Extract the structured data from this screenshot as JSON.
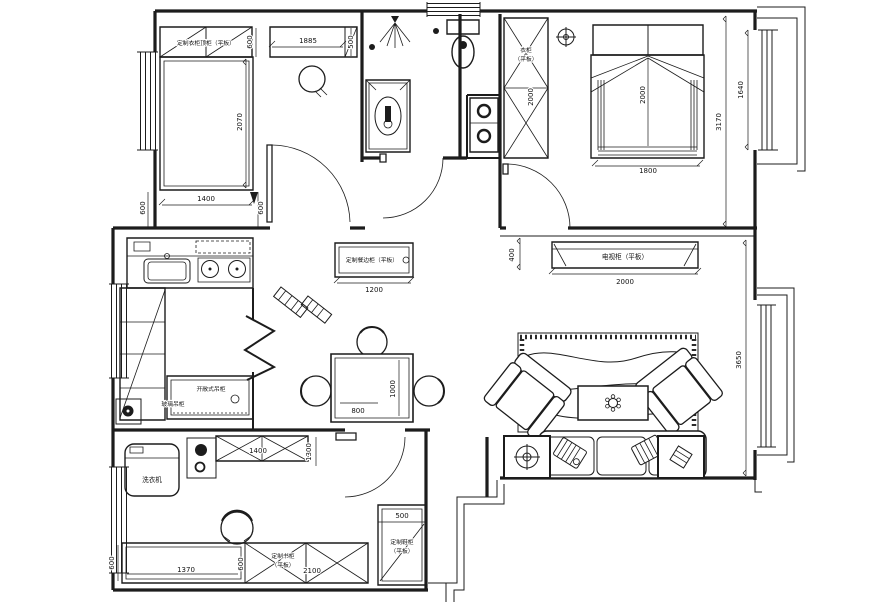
{
  "drawing": {
    "type": "apartment-floor-plan",
    "labels": {
      "wardrobe_top": "定制衣柜顶柜（平板）",
      "master_wardrobe_line1": "衣柜",
      "master_wardrobe_line2": "（平板）",
      "tv_cabinet": "电视柜（平板）",
      "sideboard": "定制餐边柜（平板）",
      "open_shelf": "开敞式吊柜",
      "glass_cabinet": "玻璃吊柜",
      "washing_machine": "洗衣机",
      "bookcase_line1": "定制书柜",
      "bookcase_line2": "（平板）",
      "shoe_cabinet_line1": "定制鞋柜",
      "shoe_cabinet_line2": "（平板）"
    },
    "dimensions": {
      "wardrobe_top_depth": "600",
      "cabinet_a_width": "1885",
      "cabinet_a_depth": "500",
      "bed_a_length": "2070",
      "room_a_left": "600",
      "room_a_bottom": "1400",
      "room_a_right": "600",
      "master_wardrobe_height": "2000",
      "master_bed_length": "2000",
      "master_bed_width": "1800",
      "master_room_depth": "3170",
      "bay_window_master": "1640",
      "tv_wall_offset": "400",
      "tv_cabinet_width": "2000",
      "sideboard_width": "1200",
      "dining_table_length": "1000",
      "dining_table_width": "800",
      "living_room_depth": "3650",
      "study_cabinet_width": "1400",
      "study_door_side": "1300",
      "desk_depth": "600",
      "desk_width": "1370",
      "desk_gap": "600",
      "bookcase_width": "2100",
      "shoe_cabinet_width": "500"
    },
    "colors": {
      "ink": "#1c1c1c",
      "paper": "#ffffff"
    }
  }
}
